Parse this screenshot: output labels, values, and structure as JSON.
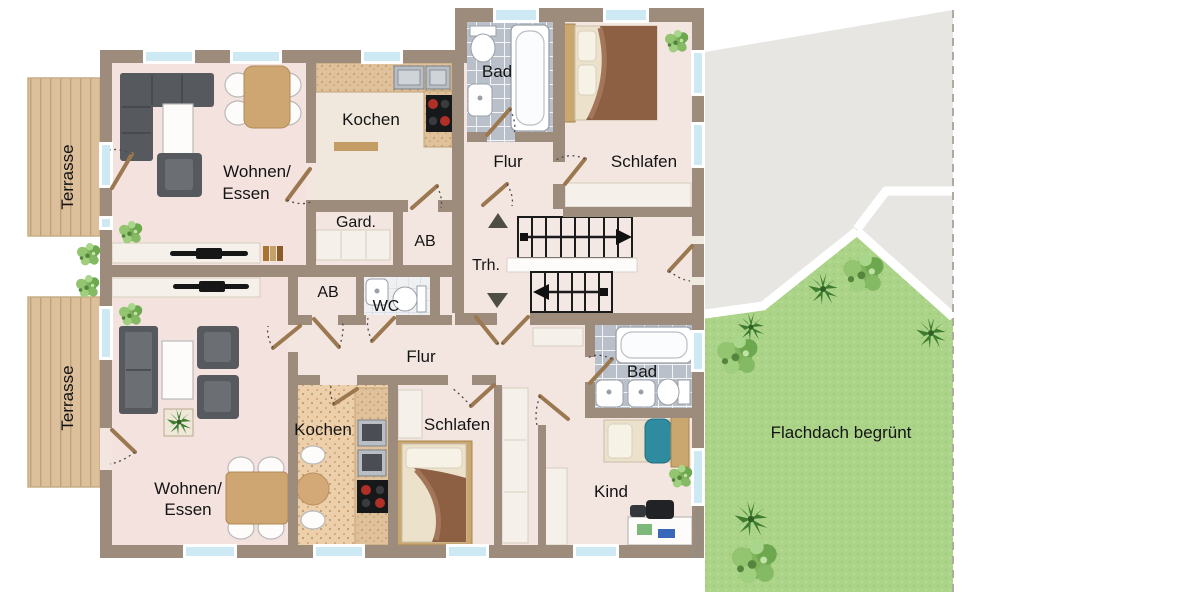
{
  "meta": {
    "type": "architectural-floor-plan",
    "floors_shown": 1,
    "units": 2
  },
  "colors": {
    "wall": "#9d8c7b",
    "floor": "#f3e6e1",
    "floor_living": "#f3e2de",
    "floor_kitchen_upper": "#f0e8dc",
    "window_glass": "#cdeaf4",
    "terrace_wood": "#dcbf9b",
    "terrace_line": "#bfa27c",
    "tile_bath": "#b9c0c9",
    "tile_wc": "#eef0f2",
    "kitchen_floor": "#ecd0ab",
    "counter": "#dfc19b",
    "grass": "#abd489",
    "roof_gray": "#e8e6e3",
    "sofa": "#56595d",
    "table_wood": "#cda672",
    "blanket_brown": "#8d5f43",
    "blanket_teal": "#2f8ba0",
    "stair": "#1b1b1b",
    "door": "#9c7851",
    "label": "#141414",
    "watermark": "#8c8c8c",
    "furniture_light": "#f5f0e9"
  },
  "labels": {
    "terrasse_upper": "Terrasse",
    "terrasse_lower": "Terrasse",
    "wohnen_upper_line1": "Wohnen/",
    "wohnen_upper_line2": "Essen",
    "kochen_upper": "Kochen",
    "bad_upper": "Bad",
    "flur_upper": "Flur",
    "schlafen_upper": "Schlafen",
    "gard": "Gard.",
    "ab_upper": "AB",
    "trh": "Trh.",
    "ab_lower": "AB",
    "wc": "WC",
    "flur_lower": "Flur",
    "wohnen_lower_line1": "Wohnen/",
    "wohnen_lower_line2": "Essen",
    "kochen_lower": "Kochen",
    "schlafen_lower": "Schlafen",
    "bad_lower": "Bad",
    "kind": "Kind",
    "flachdach": "Flachdach begrünt",
    "watermark": "McGrundriss"
  }
}
